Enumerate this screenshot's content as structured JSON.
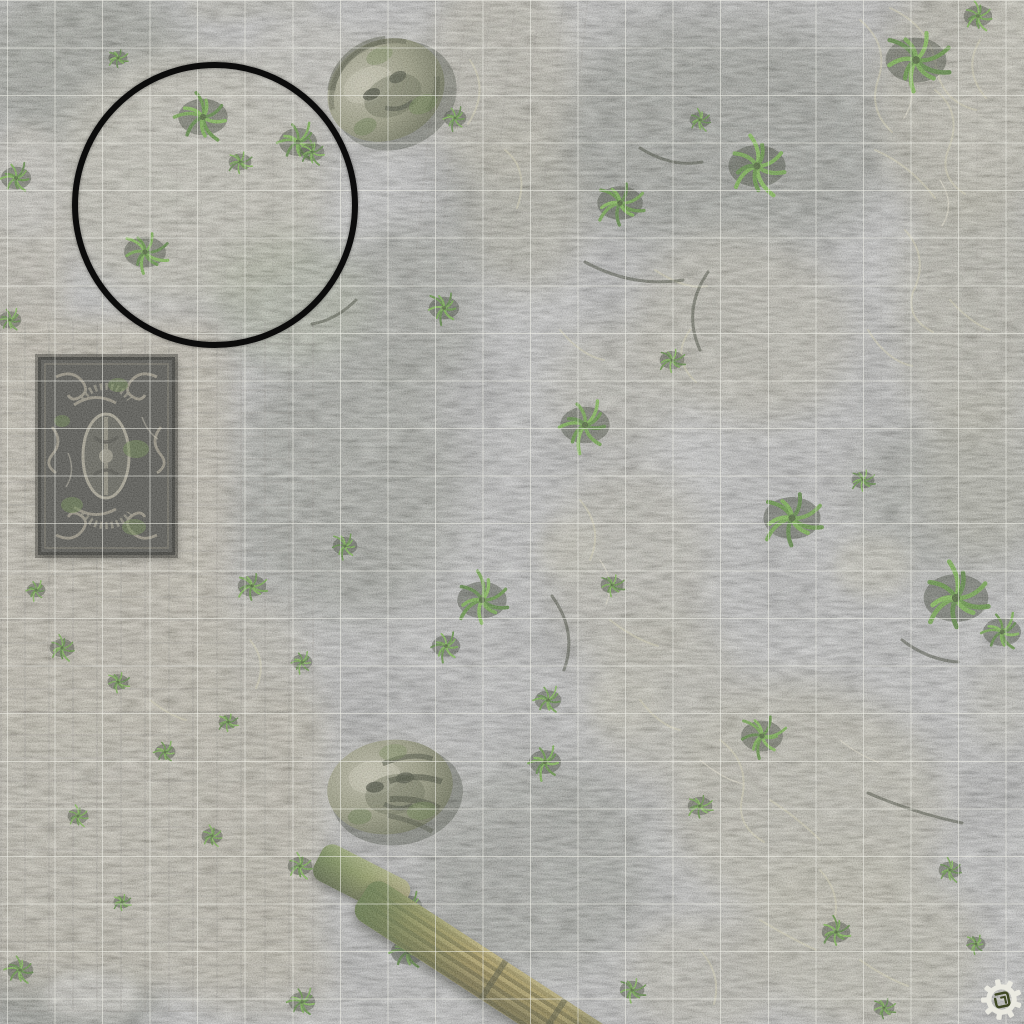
{
  "scene": {
    "type": "tabletop wargame battle mat, top-down jungle ruins with printed square grid",
    "grid": {
      "cell_size_px": 47.55,
      "offset_x": 7,
      "offset_y": 0,
      "line_color": "rgba(240,240,232,0.55)"
    },
    "deployment_circle": {
      "x": 72,
      "y": 62,
      "diameter": 286,
      "stroke_color": "#0c0c0c",
      "stroke_width": 6
    },
    "logo": {
      "icon": "gear-emblem",
      "color": "#eeede4"
    },
    "palette": {
      "grass_base": "#39431d",
      "grass_dark": "#242d11",
      "grass_light": "#5d6a26",
      "stone_tan": "#b2a375",
      "stone_pale": "#cdc9b2",
      "root_pale": "#ded8b2",
      "column_gold": "#c29a46",
      "carving_gray": "#968f79"
    }
  },
  "features": {
    "stone_heads": [
      {
        "label": "fallen stone head (north)",
        "x": 386,
        "y": 90,
        "rx": 60,
        "ry": 50,
        "rotation": -24,
        "variant": "tilted"
      },
      {
        "label": "fallen stone head (south)",
        "x": 390,
        "y": 787,
        "rx": 63,
        "ry": 47,
        "rotation": -8,
        "variant": "side"
      }
    ],
    "carved_panel": {
      "label": "carved stone relief panel",
      "x": 38,
      "y": 357,
      "width": 137,
      "height": 198
    },
    "fallen_column": {
      "label": "fallen fluted column",
      "x": 362,
      "y": 895,
      "length": 295,
      "width": 46,
      "rotation": 33
    },
    "fallen_column_stub": {
      "label": "mossy column fragment",
      "x": 318,
      "y": 858,
      "length": 98,
      "width": 40,
      "rotation": 27
    },
    "palms": [
      {
        "x": 203,
        "y": 117,
        "s": 26
      },
      {
        "x": 298,
        "y": 142,
        "s": 20
      },
      {
        "x": 145,
        "y": 252,
        "s": 22
      },
      {
        "x": 240,
        "y": 162,
        "s": 12
      },
      {
        "x": 118,
        "y": 58,
        "s": 10
      },
      {
        "x": 16,
        "y": 178,
        "s": 16
      },
      {
        "x": 10,
        "y": 320,
        "s": 12
      },
      {
        "x": 312,
        "y": 152,
        "s": 13
      },
      {
        "x": 455,
        "y": 118,
        "s": 12
      },
      {
        "x": 620,
        "y": 203,
        "s": 24
      },
      {
        "x": 757,
        "y": 166,
        "s": 30
      },
      {
        "x": 916,
        "y": 60,
        "s": 32
      },
      {
        "x": 978,
        "y": 16,
        "s": 15
      },
      {
        "x": 700,
        "y": 120,
        "s": 11
      },
      {
        "x": 585,
        "y": 425,
        "s": 26
      },
      {
        "x": 444,
        "y": 308,
        "s": 16
      },
      {
        "x": 672,
        "y": 360,
        "s": 13
      },
      {
        "x": 482,
        "y": 600,
        "s": 26
      },
      {
        "x": 446,
        "y": 646,
        "s": 15
      },
      {
        "x": 548,
        "y": 700,
        "s": 14
      },
      {
        "x": 612,
        "y": 585,
        "s": 12
      },
      {
        "x": 792,
        "y": 518,
        "s": 30
      },
      {
        "x": 956,
        "y": 598,
        "s": 34
      },
      {
        "x": 1002,
        "y": 632,
        "s": 20
      },
      {
        "x": 863,
        "y": 480,
        "s": 12
      },
      {
        "x": 62,
        "y": 648,
        "s": 13
      },
      {
        "x": 118,
        "y": 682,
        "s": 11
      },
      {
        "x": 252,
        "y": 586,
        "s": 15
      },
      {
        "x": 345,
        "y": 546,
        "s": 13
      },
      {
        "x": 302,
        "y": 662,
        "s": 11
      },
      {
        "x": 165,
        "y": 752,
        "s": 11
      },
      {
        "x": 78,
        "y": 816,
        "s": 11
      },
      {
        "x": 212,
        "y": 836,
        "s": 11
      },
      {
        "x": 300,
        "y": 866,
        "s": 13
      },
      {
        "x": 122,
        "y": 902,
        "s": 9
      },
      {
        "x": 408,
        "y": 906,
        "s": 15
      },
      {
        "x": 36,
        "y": 590,
        "s": 10
      },
      {
        "x": 228,
        "y": 722,
        "s": 10
      },
      {
        "x": 545,
        "y": 762,
        "s": 17
      },
      {
        "x": 762,
        "y": 736,
        "s": 22
      },
      {
        "x": 700,
        "y": 806,
        "s": 13
      },
      {
        "x": 836,
        "y": 932,
        "s": 15
      },
      {
        "x": 408,
        "y": 952,
        "s": 18
      },
      {
        "x": 632,
        "y": 990,
        "s": 13
      },
      {
        "x": 302,
        "y": 1002,
        "s": 14
      },
      {
        "x": 520,
        "y": 1008,
        "s": 12
      },
      {
        "x": 950,
        "y": 870,
        "s": 12
      },
      {
        "x": 884,
        "y": 1008,
        "s": 11
      },
      {
        "x": 976,
        "y": 944,
        "s": 10
      },
      {
        "x": 20,
        "y": 970,
        "s": 14
      }
    ]
  }
}
